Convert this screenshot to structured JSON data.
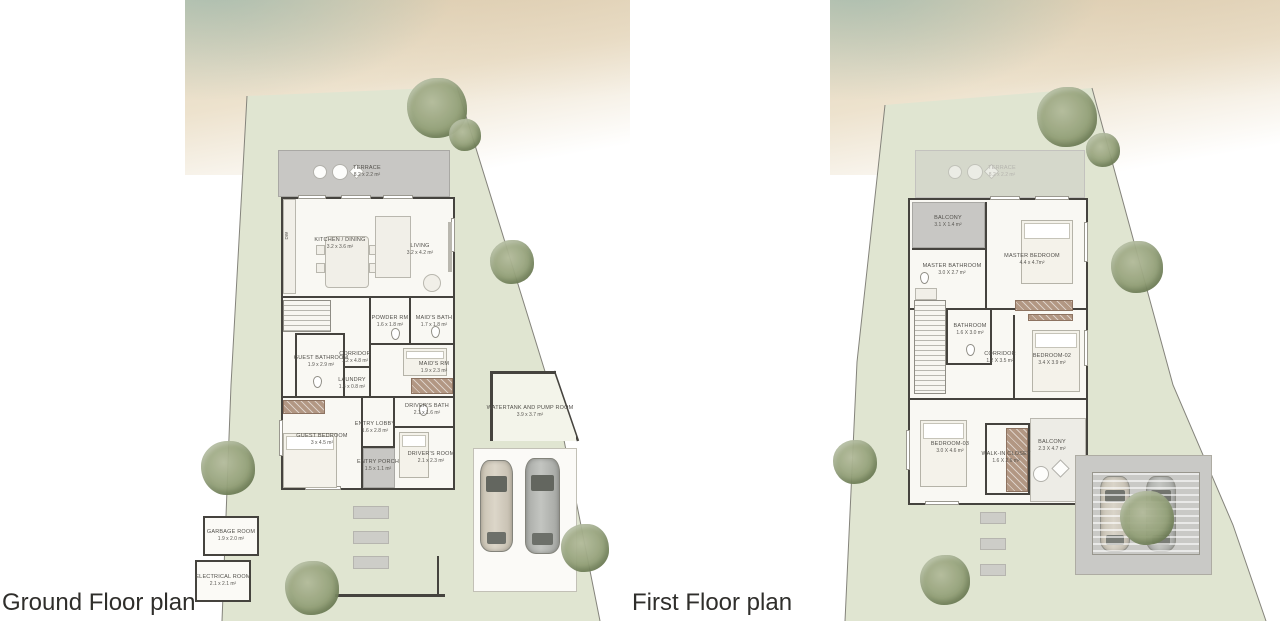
{
  "ground": {
    "title": "Ground Floor plan",
    "labels": {
      "dw": "DW"
    },
    "rooms": [
      {
        "name": "TERRACE",
        "dims": "8.2 x 2.2 m²"
      },
      {
        "name": "KITCHEN / DINING",
        "dims": "3.2 x 3.6 m²"
      },
      {
        "name": "LIVING",
        "dims": "3.2 x 4.2 m²"
      },
      {
        "name": "POWDER RM",
        "dims": "1.6 x 1.8 m²"
      },
      {
        "name": "MAID'S BATH",
        "dims": "1.7 x 1.8 m²"
      },
      {
        "name": "CORRIDOR",
        "dims": "1.2 x 4.8 m²"
      },
      {
        "name": "GUEST BATHROOM",
        "dims": "1.9 x 2.9 m²"
      },
      {
        "name": "MAID'S RM",
        "dims": "1.9 x 2.3 m²"
      },
      {
        "name": "LAUNDRY",
        "dims": "1.4 x 0.8 m²"
      },
      {
        "name": "DRIVER'S BATH",
        "dims": "2.1 x 1.6 m²"
      },
      {
        "name": "GUEST BEDROOM",
        "dims": "3 x 4.5 m²"
      },
      {
        "name": "ENTRY LOBBY",
        "dims": "1.6 x 2.8 m²"
      },
      {
        "name": "DRIVER'S ROOM",
        "dims": "2.1 x 2.3 m²"
      },
      {
        "name": "ENTRY PORCH",
        "dims": "1.5 x 1.1 m²"
      },
      {
        "name": "WATERTANK AND PUMP ROOM",
        "dims": "3.9 x 3.7 m²"
      },
      {
        "name": "GARBAGE ROOM",
        "dims": "1.9 x 2.0 m²"
      },
      {
        "name": "ELECTRICAL ROOM",
        "dims": "2.1 x 2.1 m²"
      }
    ]
  },
  "first": {
    "title": "First Floor plan",
    "rooms": [
      {
        "name": "TERRACE",
        "dims": "8.2 x 2.2 m²"
      },
      {
        "name": "BALCONY",
        "dims": "3.1 X 1.4 m²"
      },
      {
        "name": "MASTER BEDROOM",
        "dims": "4.4 x 4.7m²"
      },
      {
        "name": "MASTER BATHROOM",
        "dims": "3.0 X 2.7 m²"
      },
      {
        "name": "BATHROOM",
        "dims": "1.6 X 3.0 m²"
      },
      {
        "name": "CORRIDOR",
        "dims": "1.2 X 3.5 m²"
      },
      {
        "name": "BEDROOM-02",
        "dims": "3.4 X 3.9 m²"
      },
      {
        "name": "BEDROOM-03",
        "dims": "3.0 X 4.6 m²"
      },
      {
        "name": "WALK-IN CLOSET",
        "dims": "1.6 X 2.6 m²"
      },
      {
        "name": "BALCONY",
        "dims": "2.3 X 4.7 m²"
      }
    ]
  },
  "colors": {
    "lawn": "#e0e5d1",
    "sand": "#e9dcc3",
    "water": "#bcd6d0",
    "terrace_gray": "#c8c7c4",
    "wall": "#45433e",
    "wardrobe_wood": "#b29783",
    "tree": "#93a078",
    "car_beige": "#cdc7b8",
    "car_gray": "#b0b2ae"
  }
}
